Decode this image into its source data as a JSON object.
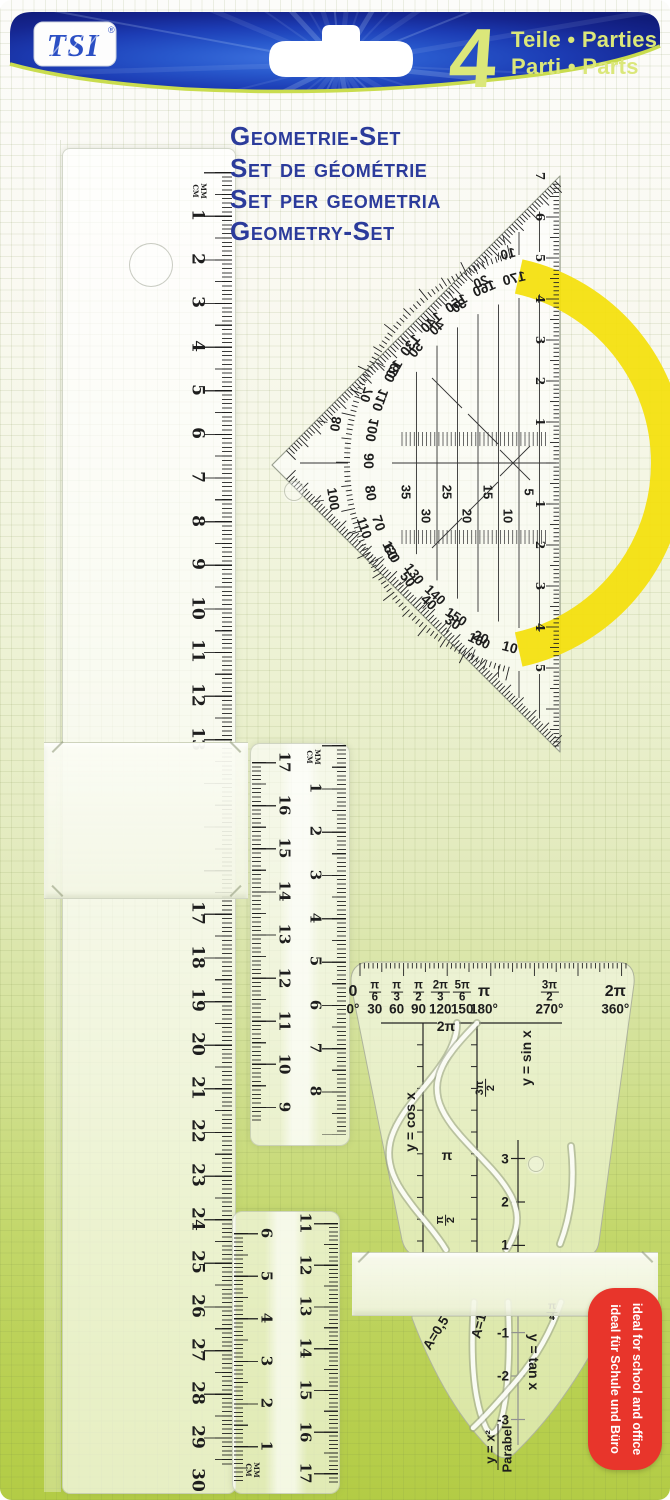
{
  "header": {
    "brand": "TSI",
    "registered_mark": "®",
    "piece_count": "4",
    "count_line1": "Teile • Parties",
    "count_line2": "Parti • Parts",
    "banner_blue": "#1c3ab2",
    "accent_lime": "#c9dc4e"
  },
  "titles": {
    "de": "Geometrie-Set",
    "fr": "Set de géométrie",
    "it": "Set per geometria",
    "en": "Geometry-Set",
    "color": "#2b3b9b"
  },
  "units": {
    "mm": "MM",
    "cm": "CM"
  },
  "left_ruler": {
    "numbers_upper": [
      1,
      2,
      3,
      4,
      5,
      6,
      7,
      8,
      9,
      10,
      11,
      12,
      13
    ],
    "numbers_lower": [
      17,
      18,
      19,
      20,
      21,
      22,
      23,
      24,
      25,
      26,
      27,
      28,
      29,
      30
    ]
  },
  "middle_ruler": {
    "left_numbers": [
      17,
      16,
      15,
      14,
      13,
      12,
      11,
      10,
      9
    ],
    "right_numbers": [
      1,
      2,
      3,
      4,
      5,
      6,
      7,
      8
    ]
  },
  "lower_ruler": {
    "left_numbers": [
      6,
      5,
      4,
      3,
      2,
      1
    ],
    "right_numbers": [
      11,
      12,
      13,
      14,
      15,
      16,
      17
    ]
  },
  "protractor": {
    "arc_color": "#f4e00a",
    "arc_degrees": [
      10,
      20,
      30,
      40,
      50,
      60,
      70,
      80,
      90,
      100,
      110,
      120,
      130,
      140,
      150,
      160,
      170
    ],
    "outer_degrees_upper": [
      10,
      20,
      30,
      40,
      50,
      60,
      70,
      80
    ],
    "outer_degrees_lower": [
      100,
      110,
      120,
      130,
      140,
      150,
      160
    ],
    "parallel_mm": [
      35,
      30,
      25,
      20,
      15,
      10,
      5
    ],
    "edge_cm_up": [
      7,
      6,
      5,
      4,
      3,
      2,
      1
    ],
    "edge_cm_down": [
      1,
      2,
      3,
      4,
      5
    ]
  },
  "trig_template": {
    "x_axis_pi": [
      "0",
      "π/6",
      "π/3",
      "π/2",
      "2π/3",
      "5π/6",
      "π",
      "3π/2",
      "2π"
    ],
    "x_axis_deg": [
      "0°",
      "30",
      "60",
      "90",
      "120",
      "150",
      "180°",
      "270°",
      "360°"
    ],
    "axis_marks": [
      "2π",
      "3π/2",
      "π",
      "π/2"
    ],
    "amplitude_numbers": [
      "3",
      "2",
      "1"
    ],
    "cos_label": "y = cos x",
    "sin_label": "y = sin x"
  },
  "parabola_template": {
    "a_label_1": "A=0,5",
    "a_label_2": "A=1",
    "tan_label": "y = tan x",
    "tan_ticks": [
      "-1",
      "-2",
      "-3"
    ],
    "quarter_pi": "π/4",
    "formula": "y = x²",
    "caption": "Parabel"
  },
  "side_badge": {
    "line_en": "ideal for school and office",
    "line_de": "ideal für Schule und Büro",
    "background": "#e8352b"
  }
}
